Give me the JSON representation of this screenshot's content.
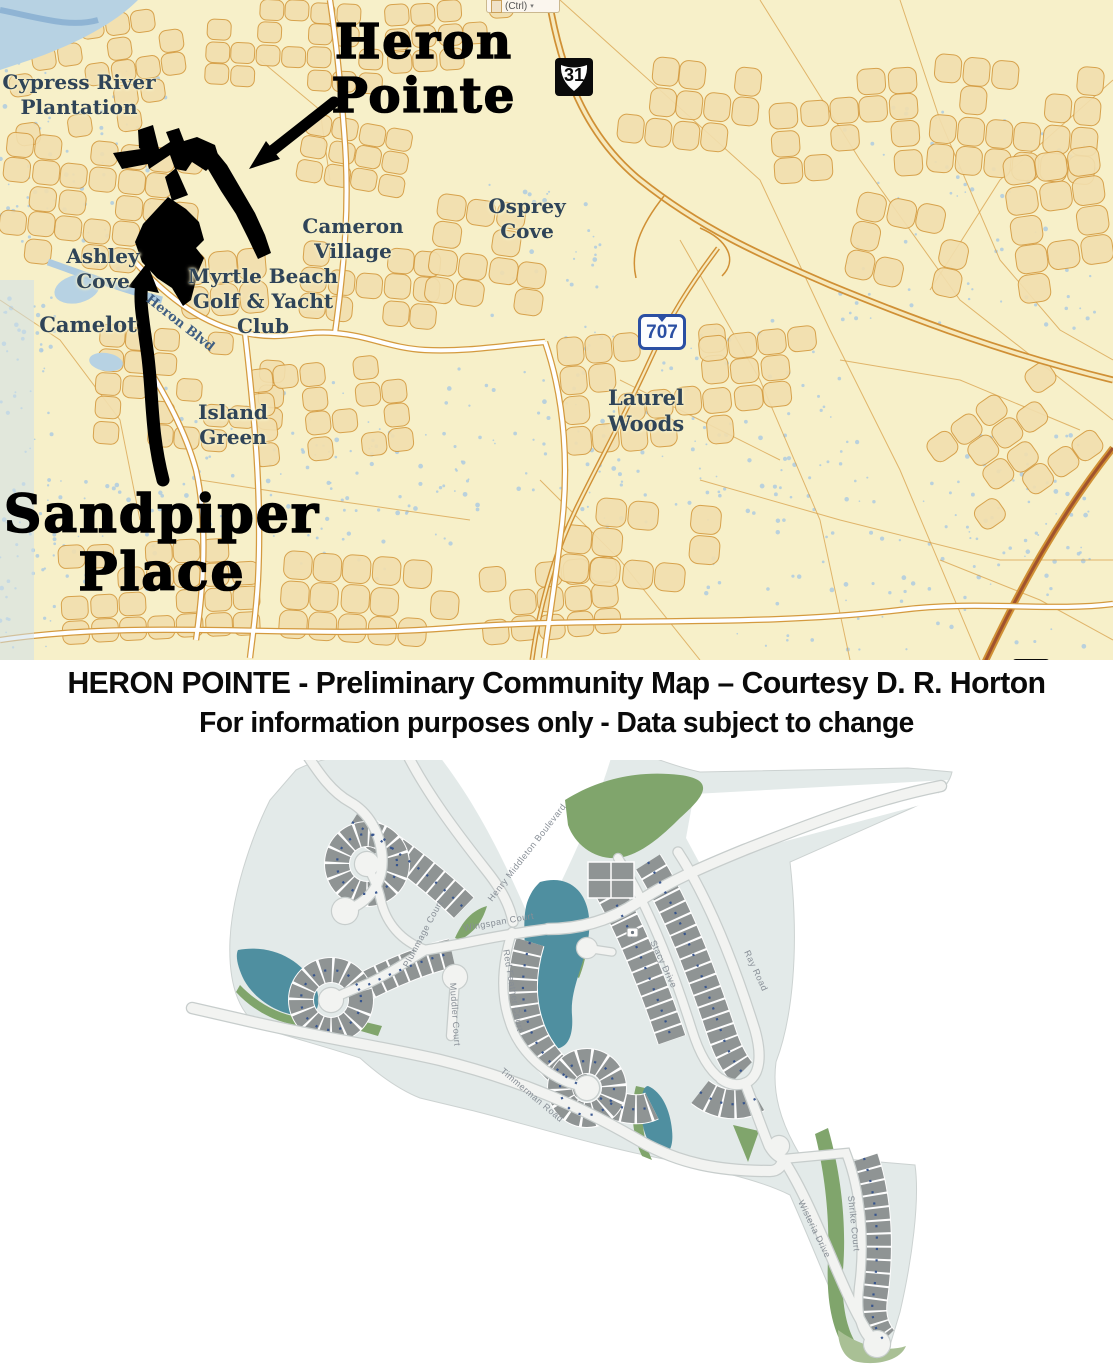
{
  "clipboard_widget": {
    "label": "(Ctrl)",
    "dropdown_icon": "▾"
  },
  "overview_map": {
    "annotations": {
      "heron_pointe": {
        "line1": "Heron",
        "line2": "Pointe"
      },
      "sandpiper_place": {
        "line1": "Sandpiper",
        "line2": "Place"
      }
    },
    "place_labels": [
      {
        "id": "cypress-river-plantation",
        "lines": [
          "Cypress River",
          "Plantation"
        ]
      },
      {
        "id": "ashley-cove",
        "lines": [
          "Ashley",
          "Cove"
        ]
      },
      {
        "id": "camelot",
        "lines": [
          "Camelot"
        ]
      },
      {
        "id": "myrtle-beach-golf-yacht-club",
        "lines": [
          "Myrtle Beach",
          "Golf & Yacht",
          "Club"
        ]
      },
      {
        "id": "cameron-village",
        "lines": [
          "Cameron",
          "Village"
        ]
      },
      {
        "id": "osprey-cove",
        "lines": [
          "Osprey",
          "Cove"
        ]
      },
      {
        "id": "island-green",
        "lines": [
          "Island",
          "Green"
        ]
      },
      {
        "id": "laurel-woods",
        "lines": [
          "Laurel",
          "Woods"
        ]
      }
    ],
    "road_labels": [
      {
        "id": "heron-blvd",
        "text": "Heron Blvd"
      }
    ],
    "route_shields": [
      {
        "id": "route-31",
        "number": "31",
        "type": "us-route"
      },
      {
        "id": "route-707",
        "number": "707",
        "type": "state-route"
      },
      {
        "id": "route-17",
        "number": "17",
        "type": "us-route"
      }
    ]
  },
  "caption": {
    "line1": "HERON POINTE - Preliminary Community Map – Courtesy D. R. Horton",
    "line2": "For information purposes only - Data subject to change"
  },
  "community_map": {
    "street_labels": [
      {
        "id": "henry-middleton-boulevard",
        "name": "Henry Middleton Boulevard"
      },
      {
        "id": "wingspan-court",
        "name": "Wingspan Court"
      },
      {
        "id": "plummage-court",
        "name": "Plummage Court"
      },
      {
        "id": "red-feather-court",
        "name": "Red Feather Court"
      },
      {
        "id": "muddler-court",
        "name": "Muddler Court"
      },
      {
        "id": "stacy-drive",
        "name": "Stacy Drive"
      },
      {
        "id": "ray-road",
        "name": "Ray Road"
      },
      {
        "id": "timmerman-road",
        "name": "Timmerman Road"
      },
      {
        "id": "wisteria-drive",
        "name": "Wisteria Drive"
      },
      {
        "id": "shrike-court",
        "name": "Shrike Court"
      }
    ]
  },
  "colors": {
    "map_background": "#f7f0c9",
    "map_road_orange": "#d49a3f",
    "water_blue": "#b7d2e3",
    "plat_land": "#e3eae9",
    "plat_lot_gray": "#8f9494",
    "plat_pond_teal": "#4f8fa0",
    "plat_green": "#80a56c",
    "annotation_black": "#000000",
    "place_label_navy": "#2f4458",
    "shield_blue": "#2b4fa3"
  }
}
